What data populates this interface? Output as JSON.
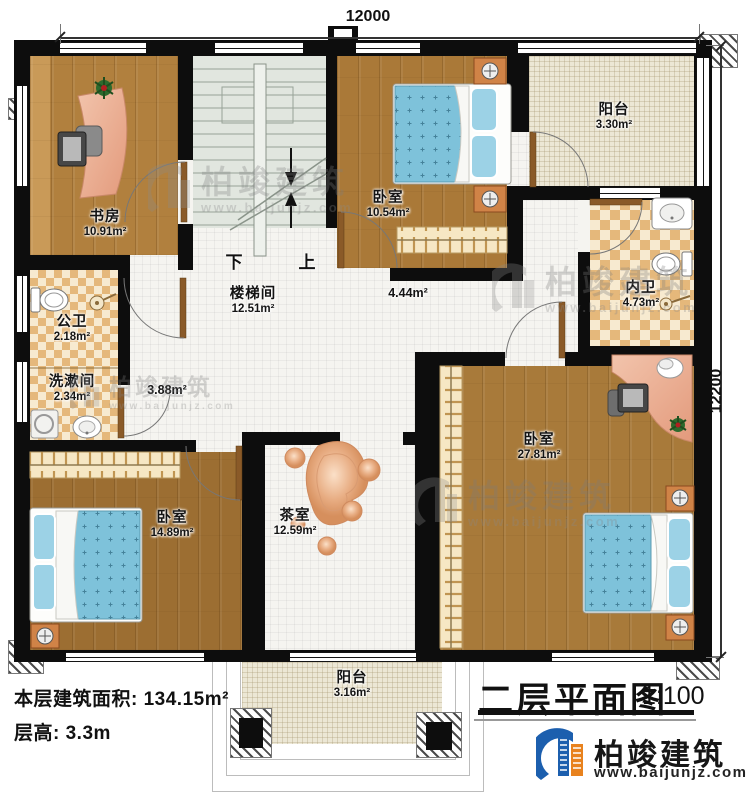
{
  "dimensions": {
    "width": "12000",
    "height": "12200"
  },
  "rooms": {
    "study": {
      "name": "书房",
      "area": "10.91m²"
    },
    "stairwell": {
      "name": "楼梯间",
      "area": "12.51m²"
    },
    "bedroom_top": {
      "name": "卧室",
      "area": "10.54m²"
    },
    "balcony_top": {
      "name": "阳台",
      "area": "3.30m²"
    },
    "inner_bath": {
      "name": "内卫",
      "area": "4.73m²"
    },
    "public_bath": {
      "name": "公卫",
      "area": "2.18m²"
    },
    "washroom": {
      "name": "洗漱间",
      "area": "2.34m²"
    },
    "hall_small": {
      "area": "3.88m²"
    },
    "hall_large": {
      "area": "4.44m²"
    },
    "bedroom_left": {
      "name": "卧室",
      "area": "14.89m²"
    },
    "tea_room": {
      "name": "茶室",
      "area": "12.59m²"
    },
    "bedroom_right": {
      "name": "卧室",
      "area": "27.81m²"
    },
    "balcony_bottom": {
      "name": "阳台",
      "area": "3.16m²"
    }
  },
  "stairs": {
    "down_label": "下",
    "up_label": "上"
  },
  "title": {
    "text": "二层平面图",
    "scale": "1:100"
  },
  "summary": {
    "floor_area": "本层建筑面积: 134.15m²",
    "floor_height": "层高: 3.3m"
  },
  "brand": {
    "name": "柏竣建筑",
    "website": "www.baijunjz.com"
  },
  "watermark": {
    "name": "柏竣建筑",
    "url": "www.baijunjz.com"
  },
  "colors": {
    "wall": "#0d0d0d",
    "wood_floor": "#b1803e",
    "bath_tile": "#e5b87b",
    "bed_blue": "#7ec2da",
    "furniture_salmon": "#edaa8d",
    "brand_blue": "#1c5fae",
    "brand_orange": "#e8821e"
  }
}
